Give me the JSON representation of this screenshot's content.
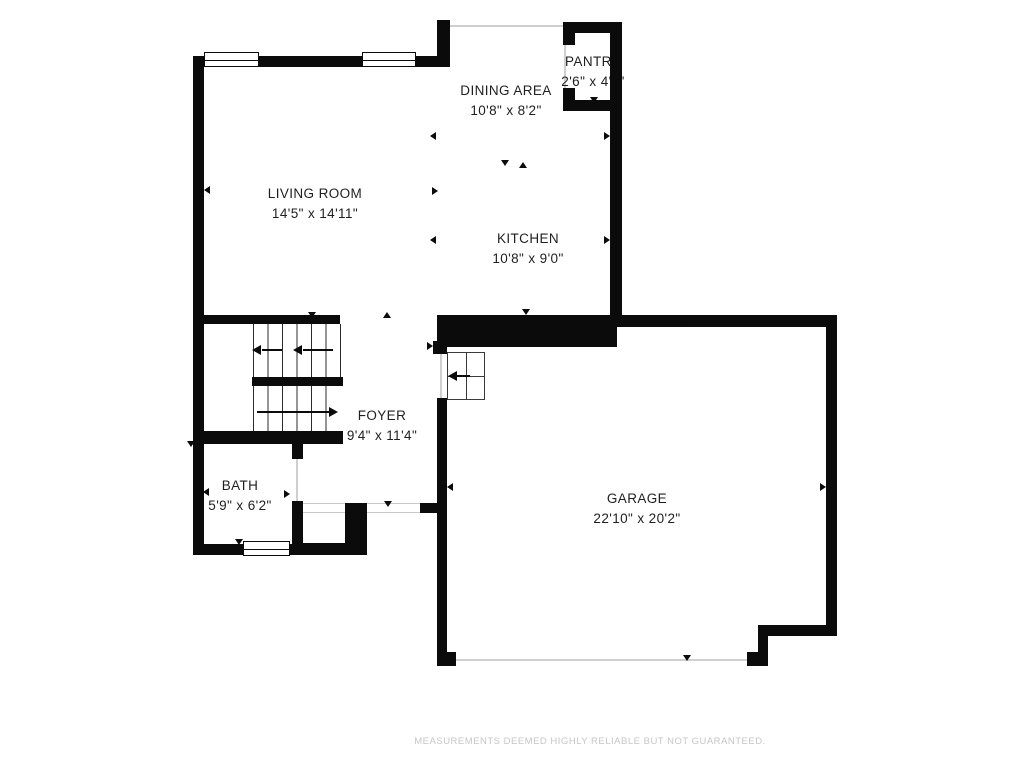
{
  "colors": {
    "background": "#ffffff",
    "wall": "#0b0b0b",
    "text": "#1f1f1f",
    "opening_line": "#cfcfcf",
    "disclaimer_text": "#c6c6c6"
  },
  "markers": {
    "dimension_tick": "small solid triangle",
    "stair_direction_arrow": "line with solid arrowhead"
  },
  "rooms": [
    {
      "id": "living-room",
      "name": "LIVING ROOM",
      "dims": "14'5\" x 14'11\""
    },
    {
      "id": "dining-area",
      "name": "DINING AREA",
      "dims": "10'8\" x 8'2\""
    },
    {
      "id": "pantry",
      "name": "PANTRY",
      "dims": "2'6\" x 4'6\""
    },
    {
      "id": "kitchen",
      "name": "KITCHEN",
      "dims": "10'8\" x 9'0\""
    },
    {
      "id": "foyer",
      "name": "FOYER",
      "dims": "9'4\" x 11'4\""
    },
    {
      "id": "bath",
      "name": "BATH",
      "dims": "5'9\" x 6'2\""
    },
    {
      "id": "garage",
      "name": "GARAGE",
      "dims": "22'10\" x 20'2\""
    }
  ],
  "footer": {
    "disclaimer": "MEASUREMENTS DEEMED HIGHLY RELIABLE BUT NOT GUARANTEED."
  }
}
